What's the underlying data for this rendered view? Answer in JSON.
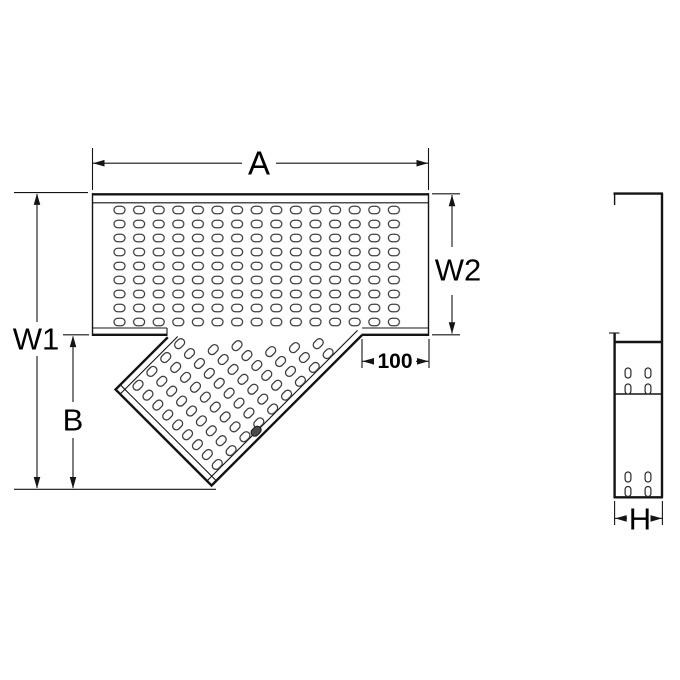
{
  "drawing": {
    "description": "Perforated cable tray 45-degree tee fitting, plan view and side view",
    "dims": {
      "overall_width": "A",
      "overall_height": "W1",
      "main_width": "W2",
      "branch_depth": "B",
      "branch_offset": "100",
      "rail_height": "H"
    }
  }
}
